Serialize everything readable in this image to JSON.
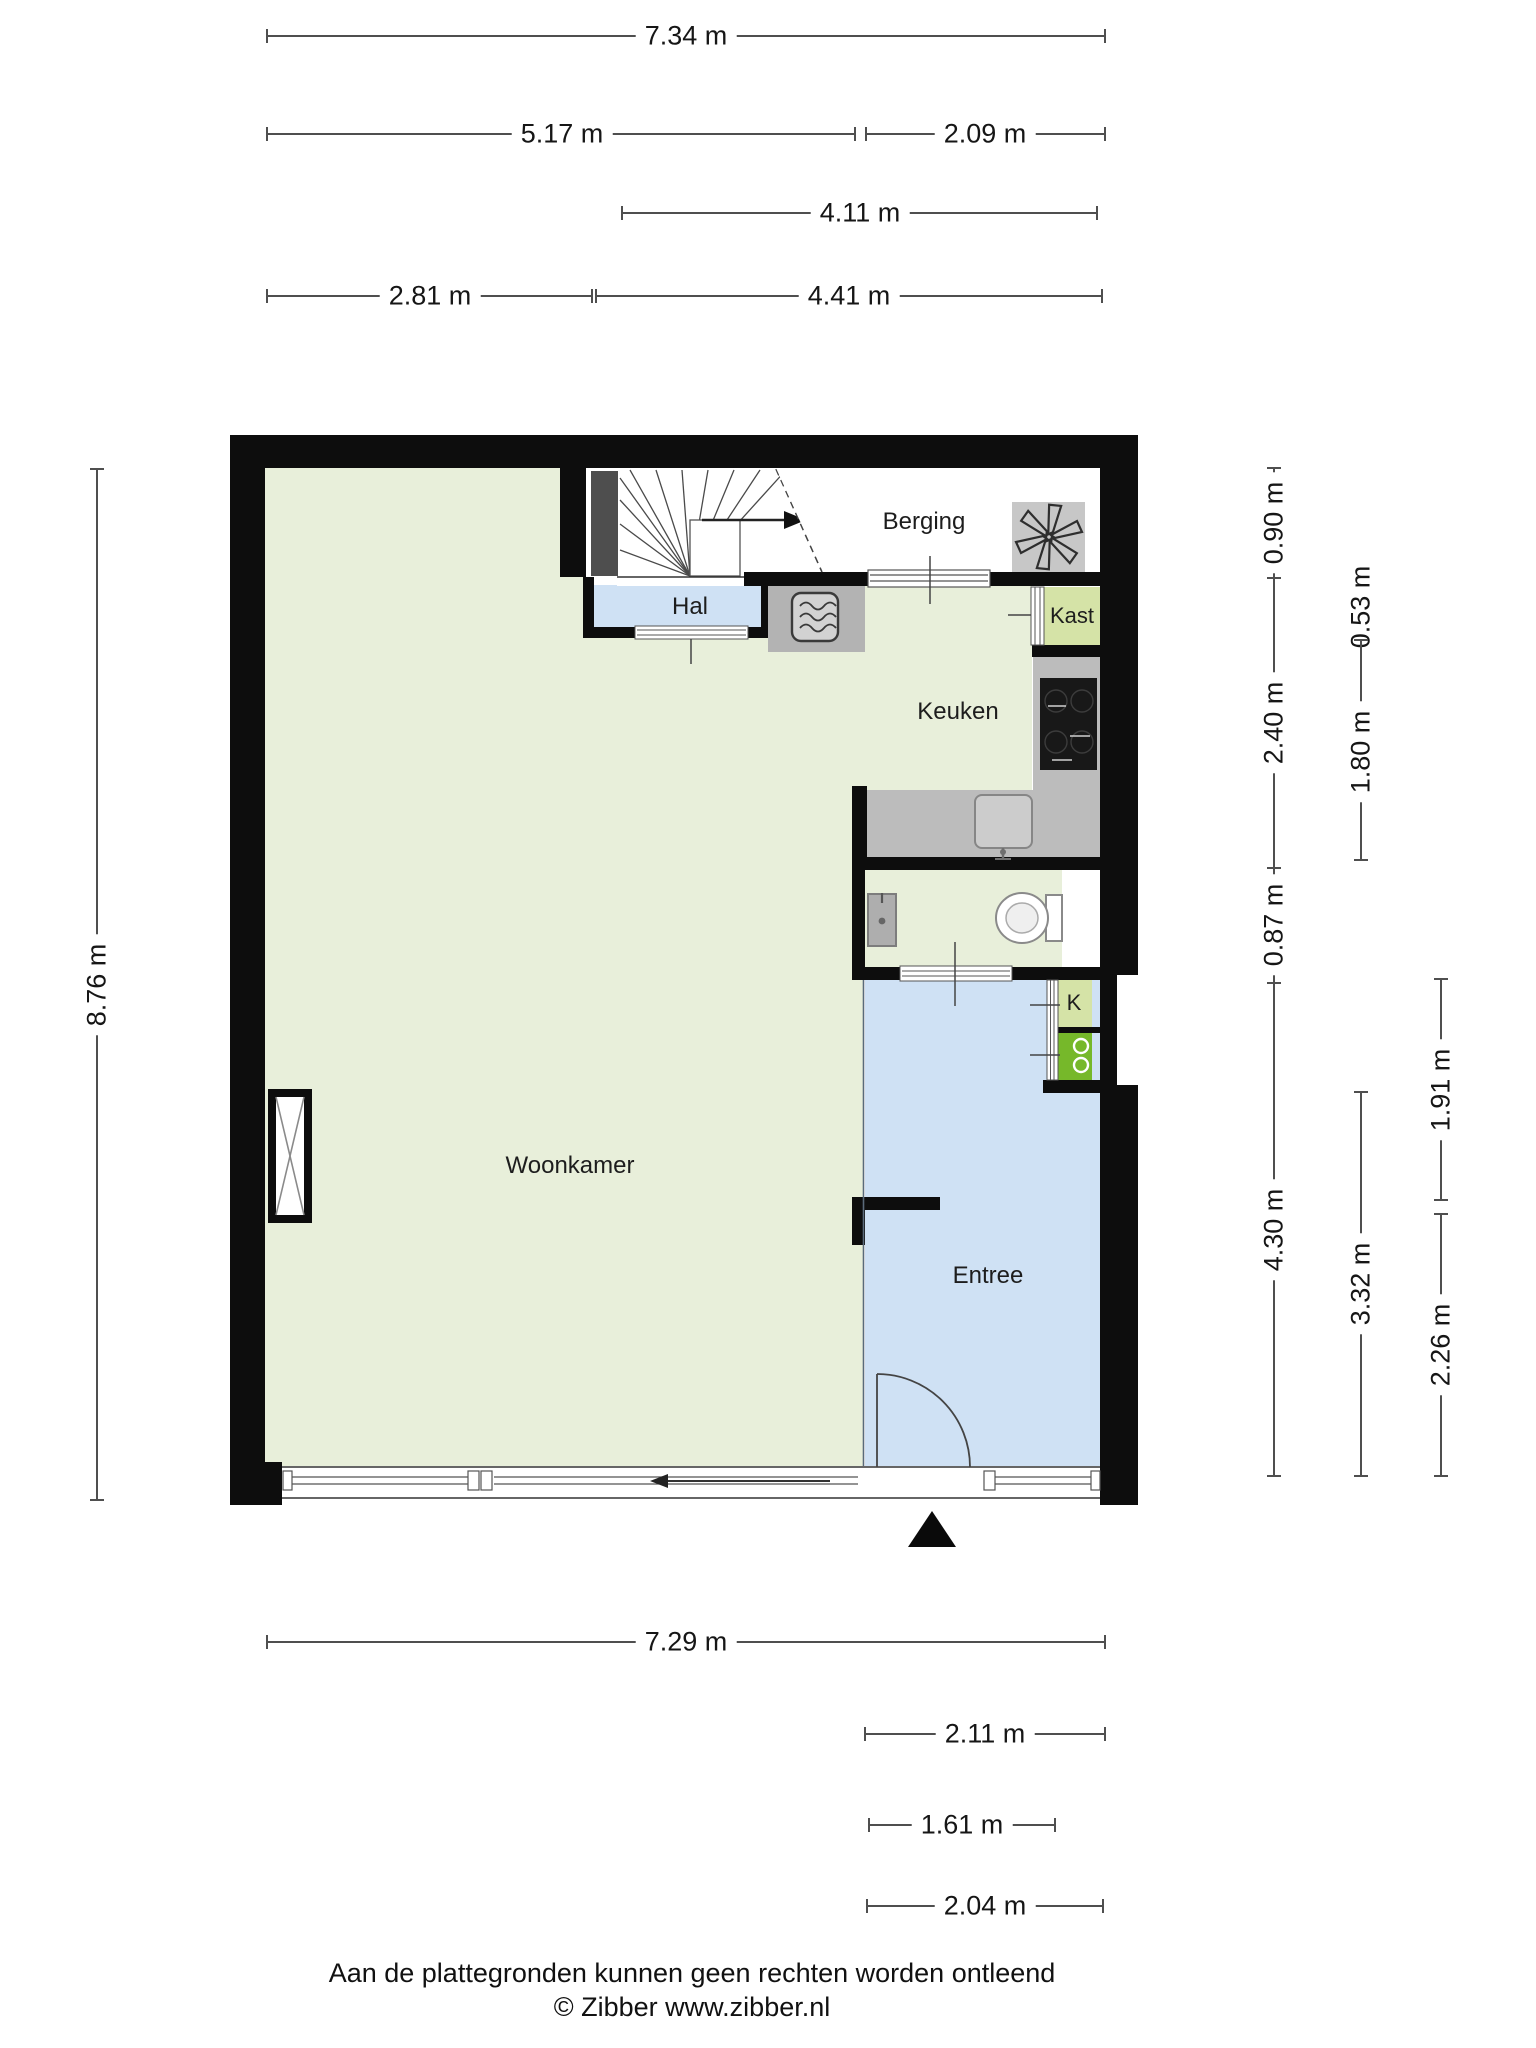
{
  "rooms": {
    "woonkamer": "Woonkamer",
    "keuken": "Keuken",
    "berging": "Berging",
    "hal": "Hal",
    "kast": "Kast",
    "entree": "Entree",
    "closet_k": "K"
  },
  "dims": {
    "top_total": "7.34 m",
    "top_left": "5.17 m",
    "top_right": "2.09 m",
    "top_mid": "4.11 m",
    "row4_left": "2.81 m",
    "row4_right": "4.41 m",
    "left_total": "8.76 m",
    "r_a1": "0.90 m",
    "r_a2": "2.40 m",
    "r_a3": "0.87 m",
    "r_a4": "4.30 m",
    "r_b1": "0.53 m",
    "r_b2": "1.80 m",
    "r_b3": "3.32 m",
    "r_c1": "1.91 m",
    "r_c2": "2.26 m",
    "b1": "7.29 m",
    "b2": "2.11 m",
    "b3": "1.61 m",
    "b4": "2.04 m"
  },
  "footer": {
    "disclaimer": "Aan de plattegronden kunnen geen rechten worden ontleend",
    "copyright": "© Zibber www.zibber.nl"
  },
  "icons": {
    "ventilation_fan": "fan-icon",
    "microwave": "microwave-icon",
    "toilet": "toilet-icon",
    "kitchen_sink": "sink-icon",
    "washbasin": "washbasin-icon",
    "washing_machine": "washing-machine-icon",
    "stairs": "stairs-icon",
    "entrance_marker": "entrance-triangle-icon",
    "duct": "duct-x-icon"
  },
  "colors": {
    "wall": "#0d0d0d",
    "room_light_green": "#e8efda",
    "room_accent_green": "#d5e3a7",
    "room_blue": "#cfe1f4",
    "appliance_green": "#76b82a",
    "counter_gray": "#bcbcbc",
    "dim_line": "#4f4f4f",
    "text": "#1d1d1d"
  }
}
